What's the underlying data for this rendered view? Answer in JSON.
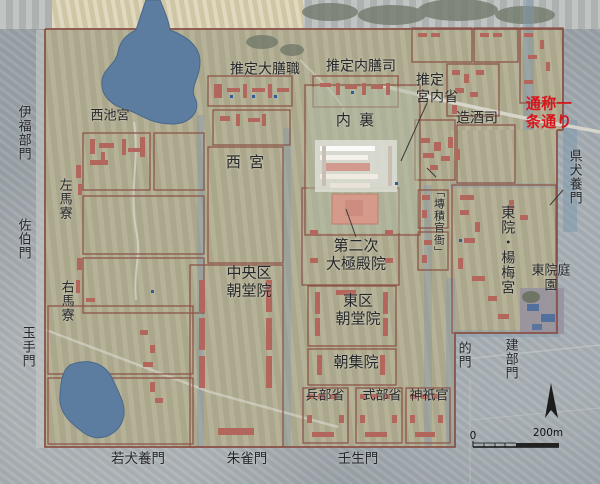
{
  "map_title": "平城宮跡 航空写真遺構図 (Heijo Palace site aerial plan)",
  "labels": {
    "suitei_daizenshiki": "推定大膳職",
    "suitei_naizenshi": "推定内膳司",
    "suitei_kunaisho": "推定\n宮内省",
    "zoshushi": "造酒司",
    "ichijo_dori_note": "通称一条通り",
    "dairi": "内裏",
    "nishi_miya": "西宮",
    "nishiike_miya": "西池宮",
    "ifukube_mon": "伊福部門",
    "saeki_mon": "佐伯門",
    "tamate_mon": "玉手門",
    "sama_ryo": "左馬寮",
    "uma_ryo": "右馬寮",
    "chuoku_chodoin": "中央区\n朝堂院",
    "dainiji_daigokudenin": "第二次\n大極殿院",
    "higashiku_chodoin": "東区\n朝堂院",
    "choshuin": "朝集院",
    "hyobusho": "兵部省",
    "shikibusho": "式部省",
    "jingikan": "神祇官",
    "senseki_kanga": "「塼積官衙」",
    "toin_yobaigu": "東院・楊梅宮",
    "toin_teien": "東院庭園",
    "mato_mon": "的門",
    "takebe_mon": "建部門",
    "agatainukai_mon": "県犬養門",
    "wakainukai_mon": "若犬養門",
    "suzaku_mon": "朱雀門",
    "mibu_mon": "壬生門"
  },
  "scale_bar": {
    "zero": "0",
    "length_label": "200m"
  },
  "icons": {
    "north_arrow": "north-arrow"
  },
  "colors": {
    "outside_grey": "#9aa2a8",
    "palace_overlay": "#b1ad92",
    "pond_blue": "#5d7da0",
    "compound_outline": "#8d564a",
    "building_red": "#b3665b",
    "daigokuden_base": "#d59a89",
    "garden_grey": "#97919f",
    "road_note_red": "#d9151c",
    "label_text": "#26272a"
  }
}
